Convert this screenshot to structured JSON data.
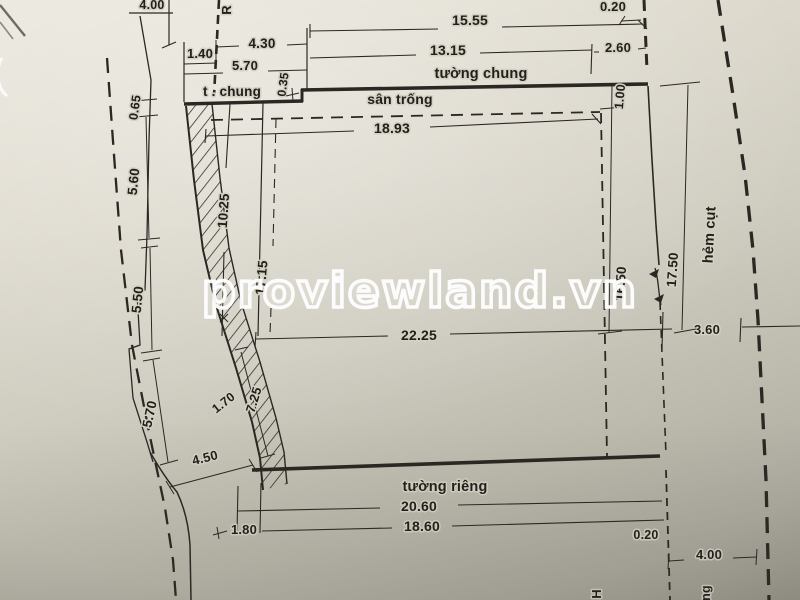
{
  "watermark": {
    "text": "proviewland.vn",
    "color": "#ffffff"
  },
  "labels": {
    "tuong_chung": "tường chung",
    "san_trong": "sân trống",
    "tuong_rieng": "tường riêng",
    "t_chung": "t . chung",
    "hem_cut": "hẻm cụt",
    "partial_r": "R",
    "partial_h": "H",
    "partial_ng": "ng",
    "partial_top_left": "4.00"
  },
  "dimensions": {
    "top": {
      "w15_55": "15.55",
      "w0_20": "0.20",
      "w13_15": "13.15",
      "w2_60": "2.60",
      "w4_30": "4.30",
      "w1_40": "1.40",
      "w5_70": "5.70",
      "w0_35": "0.35",
      "w18_93": "18.93"
    },
    "left": {
      "h0_65": "0.65",
      "h5_60": "5.60",
      "h10_25": "10.25",
      "h17_15": "17.15",
      "h5_50": "5.50",
      "h5_70": "5.70",
      "h1_70": "1.70",
      "h7_25": "7.25",
      "h4_50": "4.50"
    },
    "middle": {
      "w22_25": "22.25"
    },
    "right": {
      "h1_00": "1.00",
      "h16_50": "16.50",
      "h17_50": "17.50",
      "w3_60": "3.60",
      "w0_20": "0.20",
      "w4_00": "4.00"
    },
    "bottom": {
      "w20_60": "20.60",
      "w1_80": "1.80",
      "w18_60": "18.60"
    }
  },
  "colors": {
    "ink": "#2b2824",
    "paper": "#d6d3c7",
    "watermark": "#ffffff"
  }
}
